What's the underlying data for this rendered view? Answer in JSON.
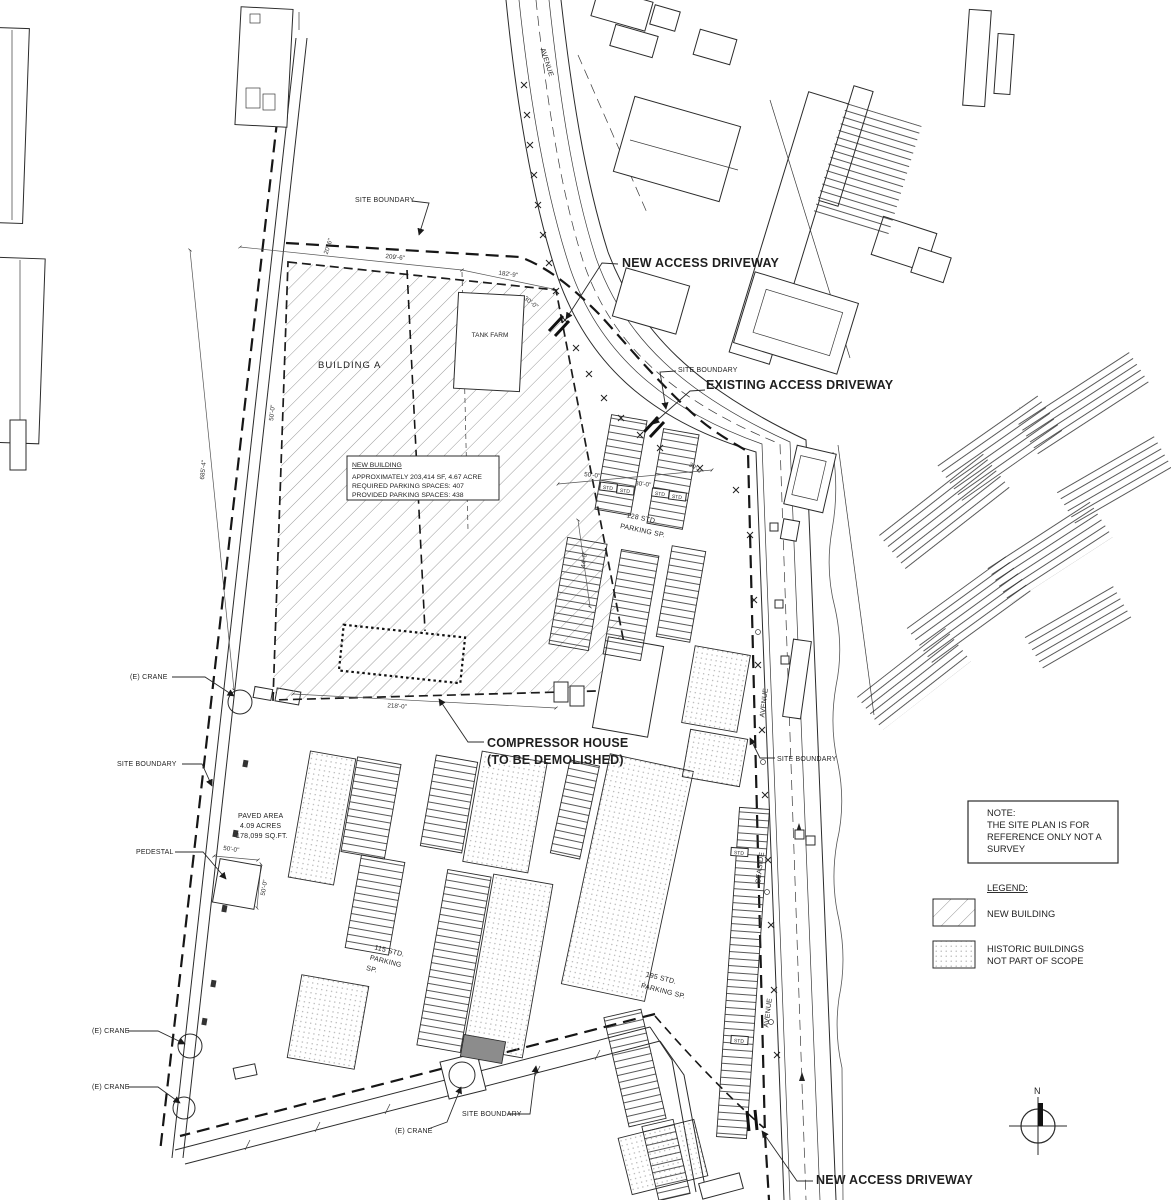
{
  "labels": {
    "site_boundary": "SITE BOUNDARY",
    "building_a": "BUILDING A",
    "tank_farm": "TANK FARM",
    "new_access_driveway": "NEW ACCESS DRIVEWAY",
    "existing_access_driveway": "EXISTING ACCESS DRIVEWAY",
    "compressor_house_line1": "COMPRESSOR HOUSE",
    "compressor_house_line2": "(TO BE DEMOLISHED)",
    "existing_crane": "(E)  CRANE",
    "pedestal": "PEDESTAL",
    "north": "N"
  },
  "streets": {
    "avenue": "AVENUE",
    "seaside": "SEASIDE"
  },
  "paved_area": {
    "line1": "PAVED AREA",
    "line2": "4.09 ACRES",
    "line3": "178,099 SQ.FT."
  },
  "parking": {
    "p115": {
      "line1": "115 STD.",
      "line2": "PARKING",
      "line3": "SP."
    },
    "p128": {
      "line1": "128 STD.",
      "line2": "PARKING SP."
    },
    "p195": {
      "line1": "195 STD.",
      "line2": "PARKING SP."
    },
    "stall_tag": "STD"
  },
  "new_building_box": {
    "title": "NEW BUILDING",
    "line1": "APPROXIMATELY 203,414 SF, 4.67 ACRE",
    "line2": "REQUIRED PARKING SPACES: 407",
    "line3": "PROVIDED PARKING SPACES: 438"
  },
  "note_box": {
    "line1": "NOTE:",
    "line2": "THE SITE PLAN IS FOR",
    "line3": "REFERENCE ONLY NOT A",
    "line4": "SURVEY"
  },
  "legend": {
    "title": "LEGEND:",
    "items": [
      {
        "swatch": "hatch",
        "label1": "NEW BUILDING",
        "label2": ""
      },
      {
        "swatch": "dots",
        "label1": "HISTORIC BUILDINGS",
        "label2": "NOT PART OF SCOPE"
      }
    ]
  },
  "dimensions": {
    "d209": "209'-6\"",
    "d182": "182'-9\"",
    "d30": "30'-0\"",
    "d20": "20'-6\"",
    "d685": "685'-4\"",
    "d50": "50'-0\"",
    "d44": "44'-6\"",
    "d218": "218'-0\""
  },
  "colors": {
    "line": "#2b2b2b",
    "hatch": "#8f8f8f",
    "stipple": "#ababab",
    "background": "#ffffff"
  }
}
